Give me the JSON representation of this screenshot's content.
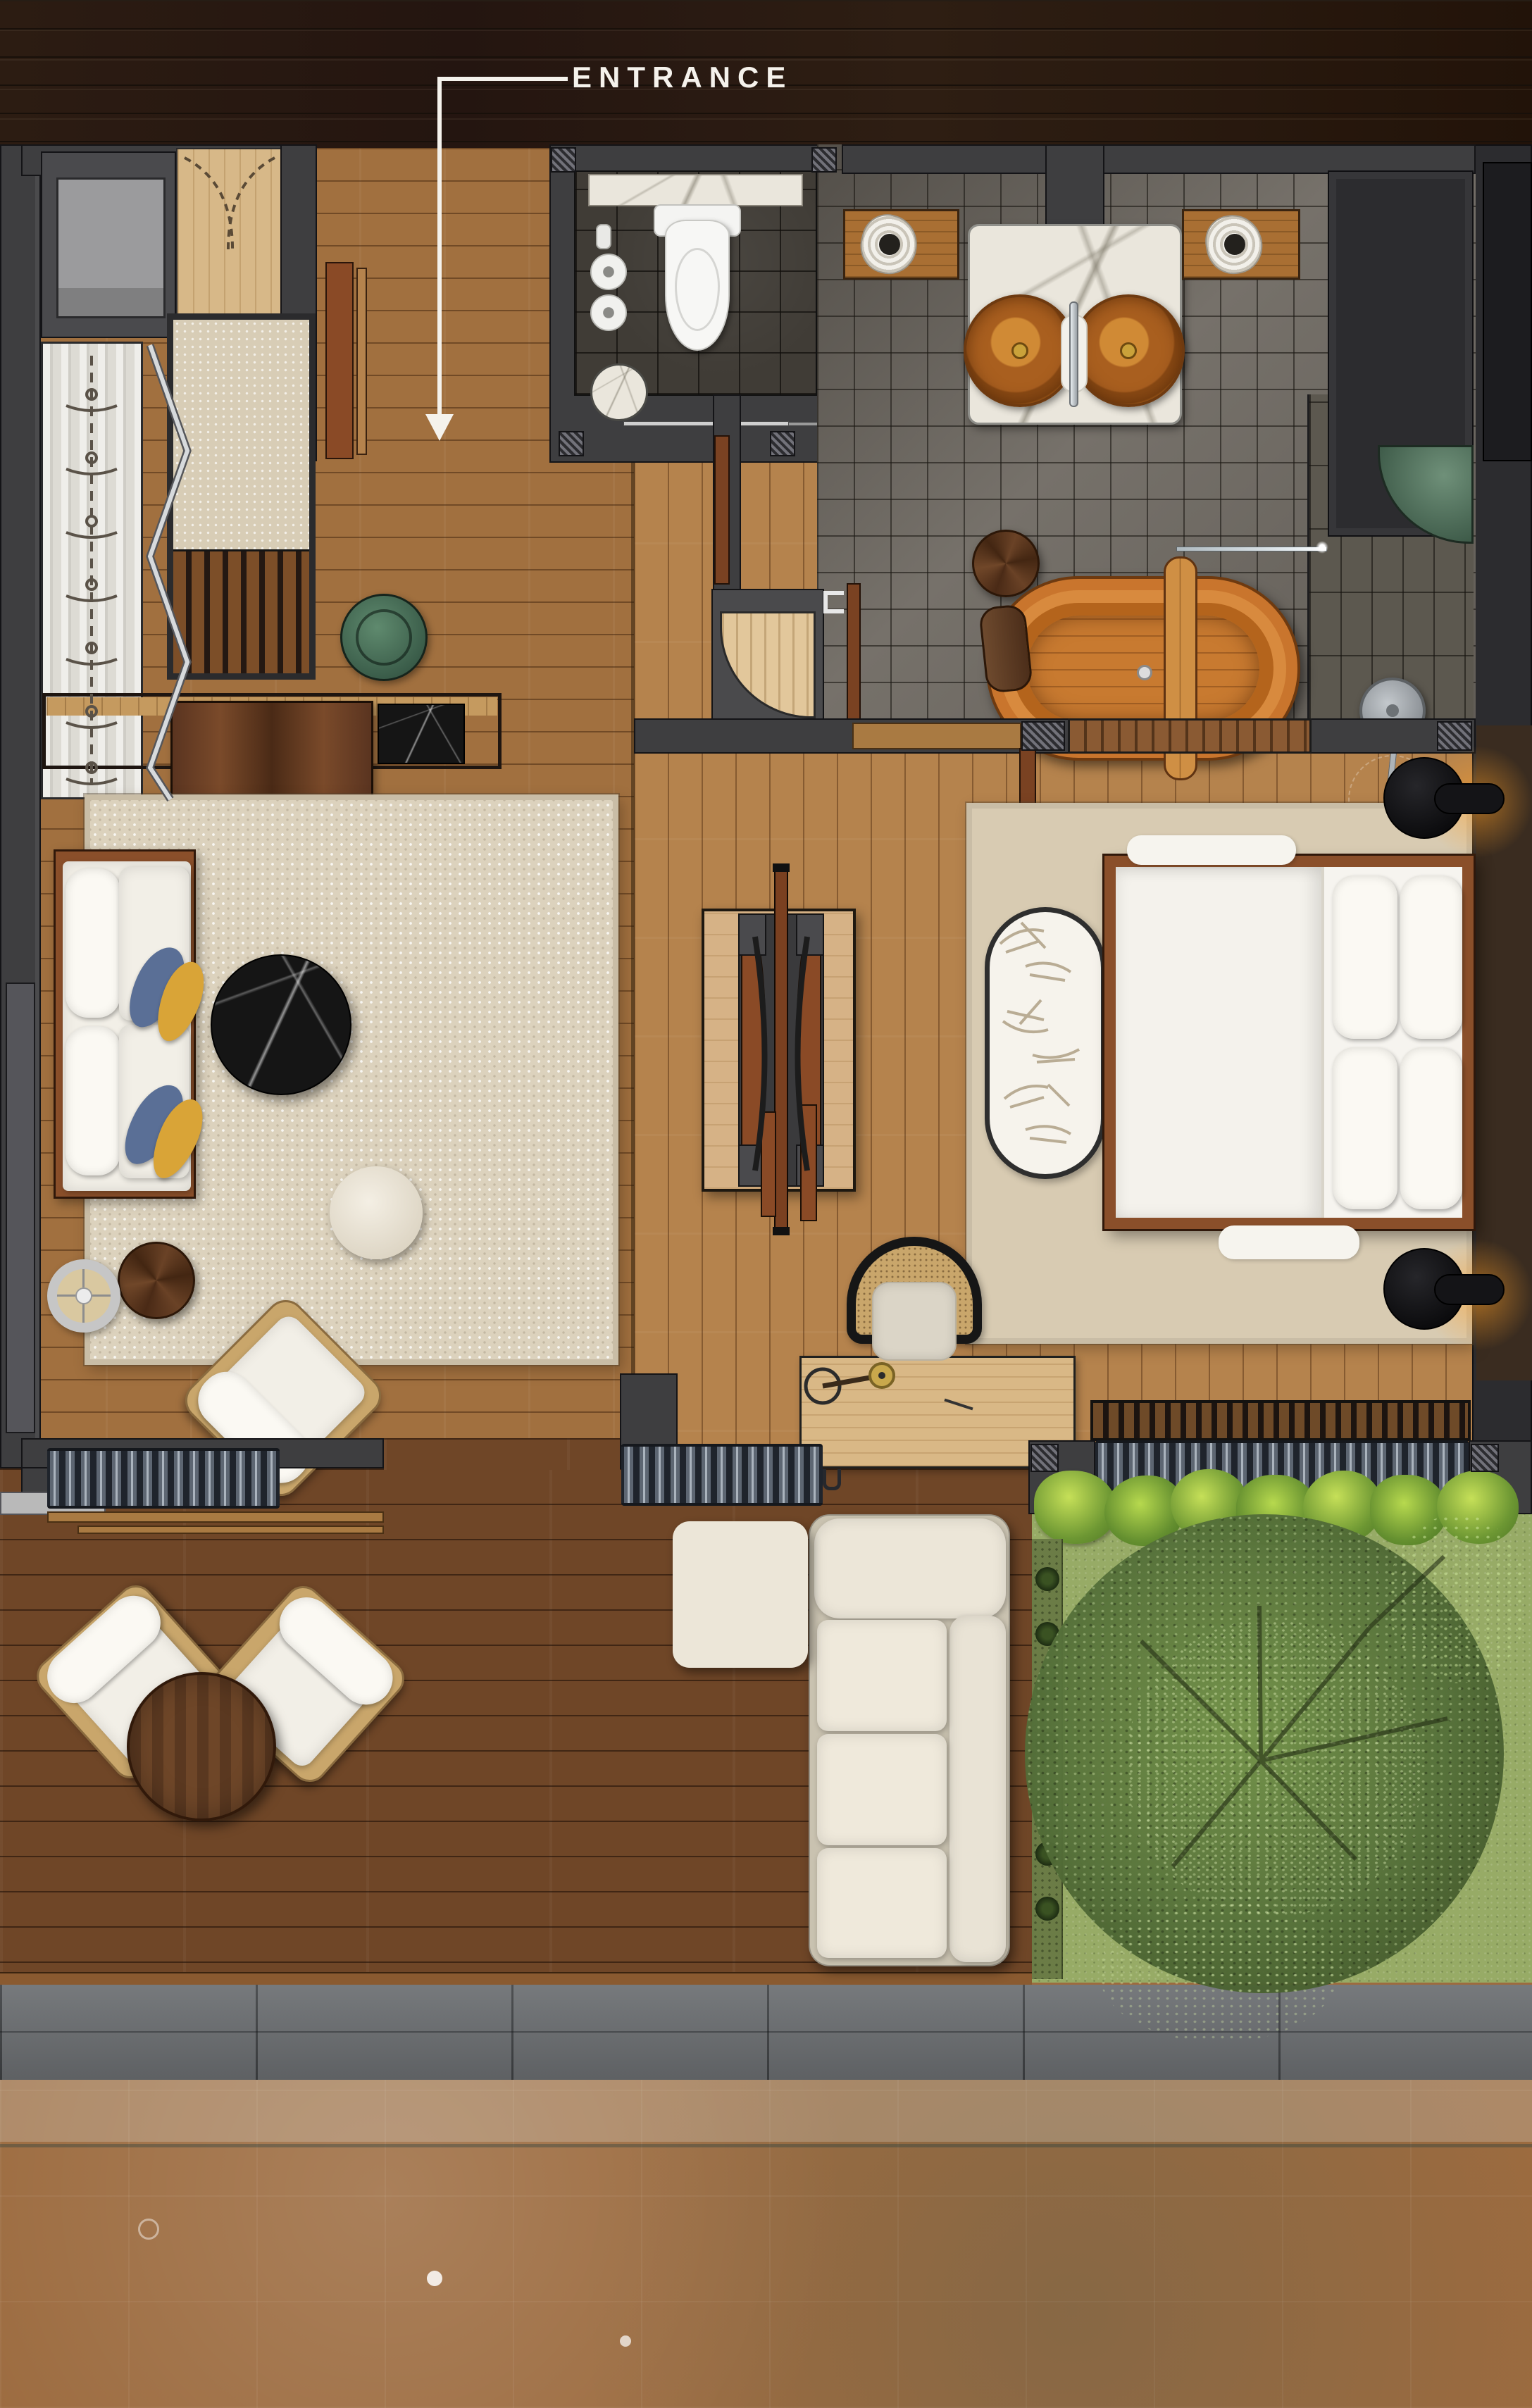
{
  "plan": {
    "entrance_label": "ENTRANCE",
    "palette": {
      "roof_wood": "#271811",
      "interior_wood": "#a9784a",
      "deck_wood": "#6f4627",
      "wall_grey": "#3e3e40",
      "bath_tile": "#76716a",
      "tub_wood": "#c9752d",
      "rug_beige": "#dcd2bd",
      "pool_water": "#84b3b7",
      "grass_green": "#97ab66",
      "accent_green": "#5f8069"
    },
    "rooms": [
      {
        "name": "Entry & Wardrobe",
        "furniture": [
          "entry double door",
          "wardrobe cabinet",
          "hanging closet",
          "upholstered bench",
          "green tray"
        ]
      },
      {
        "name": "WC",
        "furniture": [
          "toilet",
          "marble shelf",
          "toilet paper rolls",
          "marble stool",
          "sliding door"
        ]
      },
      {
        "name": "Bathroom",
        "furniture": [
          "double wooden basin vanity",
          "towel shelves",
          "storage unit",
          "wooden bathtub",
          "bath tray",
          "headrest",
          "wooden stool",
          "glass screen",
          "rain shower",
          "shower valve",
          "green stone bench"
        ]
      },
      {
        "name": "Living Room",
        "furniture": [
          "console table",
          "media cabinet",
          "marble tray",
          "sofa with pillows",
          "round marble coffee table",
          "round pouf",
          "round side table",
          "floor lamp",
          "lounge armchair"
        ]
      },
      {
        "name": "Hall",
        "furniture": [
          "double-sided console divider",
          "sliding panels"
        ]
      },
      {
        "name": "Bedroom",
        "furniture": [
          "double bed",
          "pillows",
          "leaf oval rug",
          "bedside tables",
          "bedside lamps",
          "slat bench",
          "desk",
          "desk lamp",
          "cane chair"
        ]
      },
      {
        "name": "Terrace",
        "furniture": [
          "sectional sofa",
          "ottoman",
          "two lounge chairs",
          "round wood table",
          "folding doors"
        ]
      },
      {
        "name": "Garden",
        "furniture": [
          "tree",
          "shrub row",
          "planter strip"
        ]
      },
      {
        "name": "Pool",
        "furniture": [
          "stone coping"
        ]
      }
    ]
  }
}
